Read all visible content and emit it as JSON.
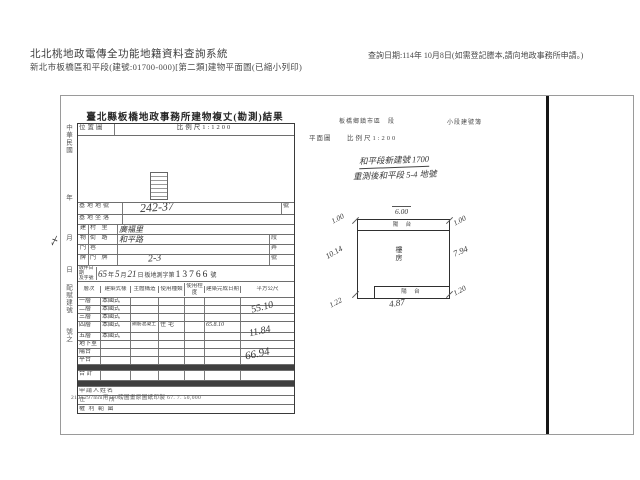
{
  "header": {
    "system_title": "北北桃地政電傳全功能地籍資料查詢系統",
    "subtitle": "新北市板橋區和平段(建號:01700-000)[第二類]建物平面圖(已縮小列印)",
    "query_date": "查詢日期:114年 10月8日(如需登記謄本,請向地政事務所申請。)"
  },
  "margin": {
    "era": "中華民國",
    "year": "年",
    "month": "月",
    "day": "日",
    "note": "配賦建號",
    "suffix": "號之",
    "check_mark": "〆"
  },
  "form": {
    "title": "臺北縣板橋地政事務所建物複丈(勘測)結果",
    "location_label": "位置圖",
    "location_scale": "比例尺1:1200",
    "base_no_label": "基地地號",
    "base_no_value": "242-37",
    "base_no_unit": "號",
    "base_loc_label": "基地坐落",
    "door_group": [
      "建",
      "物",
      "門",
      "牌"
    ],
    "village_label": "村 里",
    "village_value": "廣福里",
    "street_label": "街 路",
    "street_value": "和平路",
    "street_unit": "段",
    "lane_label": "巷",
    "alley_label": "弄",
    "door_label": "門 牌",
    "door_value": "2-3",
    "door_unit": "號",
    "receipt_label_top": "收件日期",
    "receipt_label_bottom": "及字號",
    "receipt_year": "65",
    "receipt_year_unit": "年",
    "receipt_month": "5",
    "receipt_month_unit": "月",
    "receipt_day": "21",
    "receipt_day_unit": "日",
    "receipt_prefix": "板地測字第",
    "receipt_number": "13766",
    "receipt_suffix": "號",
    "grid_headers": [
      "層次",
      "建築式樣",
      "主體構造",
      "使用種類",
      "使用程度",
      "建築完成日期",
      "平方公尺"
    ],
    "floors": [
      {
        "layer": "一層",
        "style": "本國式",
        "structure": "",
        "use": "",
        "degree": "",
        "date": ""
      },
      {
        "layer": "二層",
        "style": "本國式",
        "structure": "",
        "use": "",
        "degree": "",
        "date": ""
      },
      {
        "layer": "三層",
        "style": "本國式",
        "structure": "",
        "use": "",
        "degree": "",
        "date": ""
      },
      {
        "layer": "四層",
        "style": "本國式",
        "structure": "鋼筋混凝土",
        "use": "住宅",
        "degree": "",
        "date": "65.8.10"
      },
      {
        "layer": "五層",
        "style": "本國式",
        "structure": "",
        "use": "",
        "degree": "",
        "date": ""
      },
      {
        "layer": "地下室",
        "style": "",
        "structure": "",
        "use": "",
        "degree": "",
        "date": ""
      },
      {
        "layer": "陽台",
        "style": "",
        "structure": "",
        "use": "",
        "degree": "",
        "date": ""
      },
      {
        "layer": "平台",
        "style": "",
        "structure": "",
        "use": "",
        "degree": "",
        "date": ""
      }
    ],
    "total_label": "合 計",
    "areas": {
      "floor4": "55.10",
      "balcony": "11.84",
      "total": "66.94"
    },
    "applicant_label": "申請人姓名",
    "address_label": "住　　所",
    "rights_label": "權 利 範 圍",
    "footnote": "210×297mm用100磅圖畫原圖紙印製 67. 7. 50,000"
  },
  "plan": {
    "header_left": "板橋鄉鎮市區　段",
    "header_right": "小段建號簿",
    "label": "平面圖",
    "scale": "比例尺1:200",
    "note_line1": "和平段新建號 1700",
    "note_line2": "重測後和平段 5-4 地號",
    "balcony_top_label": "陽 台",
    "balcony_bottom_label": "陽 台",
    "center_label": "樓房",
    "dims": {
      "top": "6.00",
      "top_left": "1.00",
      "top_right": "1.00",
      "left": "10.14",
      "right": "7.94",
      "bottom": "4.87",
      "bottom_left": "1.22",
      "bottom_right": "1.20"
    }
  }
}
